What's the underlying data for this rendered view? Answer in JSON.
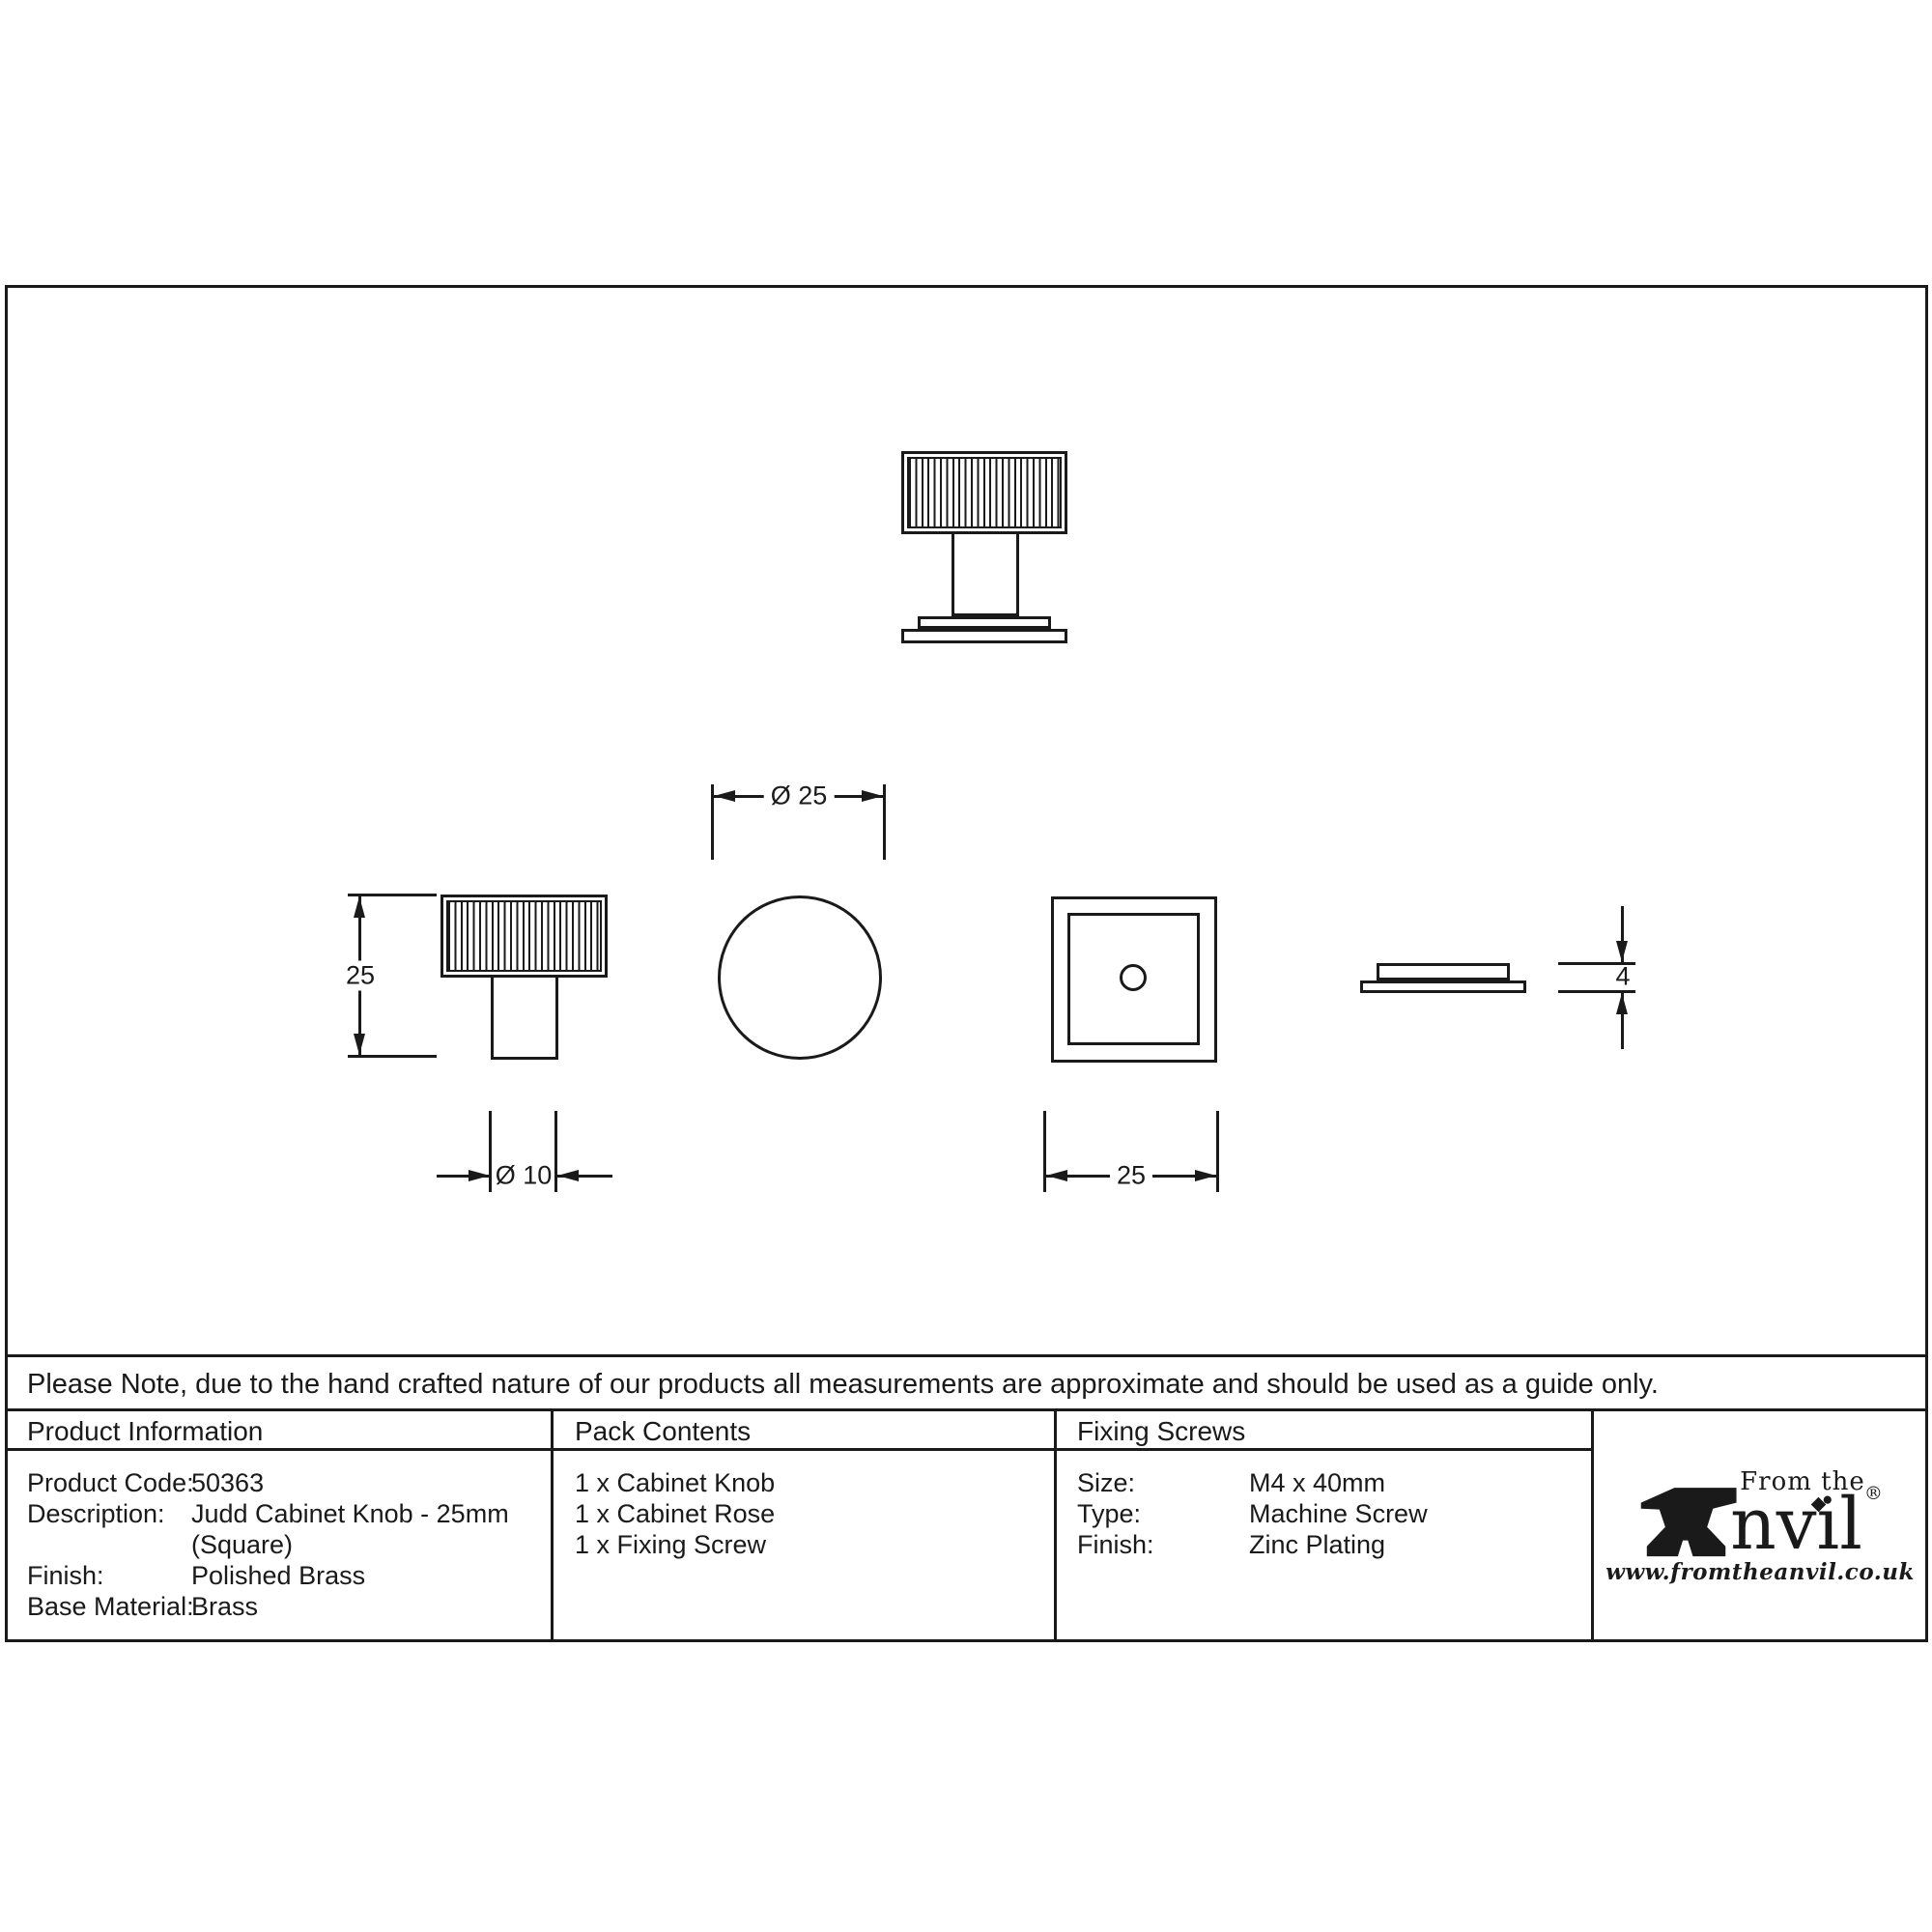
{
  "note": "Please Note, due to the hand crafted nature of our products all measurements are approximate and should be used as a guide only.",
  "table": {
    "product_information": {
      "header": "Product Information",
      "rows": [
        {
          "label": "Product Code:",
          "value": "50363"
        },
        {
          "label": "Description:",
          "value": "Judd Cabinet Knob - 25mm"
        },
        {
          "label": "",
          "value": "(Square)"
        },
        {
          "label": "Finish:",
          "value": "Polished Brass"
        },
        {
          "label": "Base Material:",
          "value": "Brass"
        }
      ]
    },
    "pack_contents": {
      "header": "Pack Contents",
      "items": [
        "1 x Cabinet Knob",
        "1 x Cabinet Rose",
        "1 x Fixing Screw"
      ]
    },
    "fixing_screws": {
      "header": "Fixing Screws",
      "rows": [
        {
          "label": "Size:",
          "value": "M4 x 40mm"
        },
        {
          "label": "Type:",
          "value": "Machine Screw"
        },
        {
          "label": "Finish:",
          "value": "Zinc Plating"
        }
      ]
    }
  },
  "drawings": {
    "dim_knob_height": "25",
    "dim_stem_diameter": "Ø 10",
    "dim_knob_diameter": "Ø 25",
    "dim_rose_width": "25",
    "dim_rose_thickness": "4"
  },
  "logo": {
    "from_the": "From the",
    "anvil_suffix": "nvil",
    "registered": "®",
    "url": "www.fromtheanvil.co.uk",
    "anvil_icon": "anvil-icon"
  },
  "colors": {
    "line": "#1a1a1a",
    "background": "#ffffff"
  }
}
